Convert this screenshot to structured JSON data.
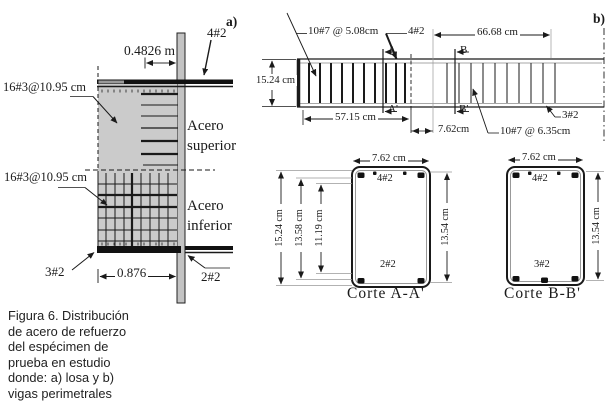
{
  "colors": {
    "line": "#1a1a1a",
    "slab_fill": "#cbcbcb",
    "column_fill": "#c3c3c3"
  },
  "panel_a": {
    "label": "a)",
    "top_width_dim": "0.4826 m",
    "top_beam_bars": "4#2",
    "top_mesh_label": "16#3@10.95 cm",
    "bottom_mesh_label": "16#3@10.95 cm",
    "top_steel_text": "Acero superior",
    "bottom_steel_text": "Acero inferior",
    "bottom_left_bars": "3#2",
    "bottom_width_dim": "0.876",
    "bottom_right_bars": "2#2"
  },
  "panel_b": {
    "label": "b)",
    "elevation": {
      "left_stirrups": "10#7 @ 5.08cm",
      "top_bars": "4#2",
      "right_span_dim": "66.68 cm",
      "height_dim": "15.24 cm",
      "cut_a_top": "A",
      "cut_a_bottom": "A'",
      "cut_b_top": "B",
      "cut_b_bottom": "B'",
      "left_span_dim": "57.15 cm",
      "gap_dim": "7.62cm",
      "right_stirrups": "10#7 @ 6.35cm",
      "bottom_bars": "3#2"
    },
    "section_a": {
      "title": "Corte A-A'",
      "width_dim": "7.62 cm",
      "top_bars": "4#2",
      "bottom_bars": "2#2",
      "height_dim_outer": "15.24 cm",
      "height_dim_mid": "13.58 cm",
      "height_dim_inner": "11.19 cm",
      "height_dim_right": "13.54 cm"
    },
    "section_b": {
      "title": "Corte B-B'",
      "width_dim": "7.62 cm",
      "top_bars": "4#2",
      "bottom_bars": "3#2",
      "height_dim_right": "13.54 cm"
    }
  },
  "caption": {
    "lines": [
      "Figura 6. Distribución",
      "de acero de refuerzo",
      "del espécimen de",
      "prueba en estudio",
      "donde: a) losa y b)",
      "vigas perimetrales"
    ]
  }
}
